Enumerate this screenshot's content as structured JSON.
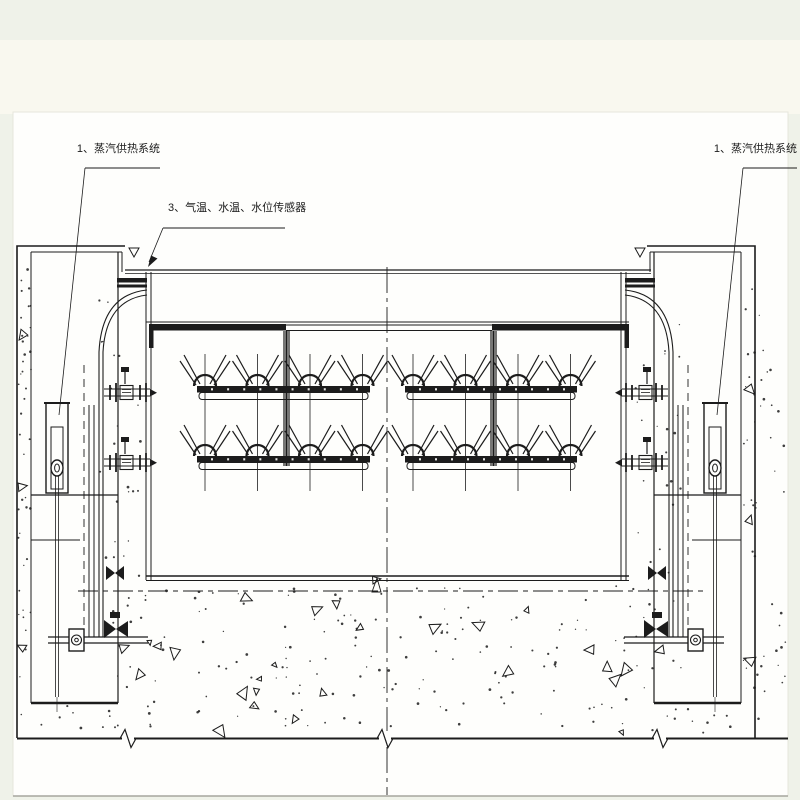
{
  "page": {
    "background": "#eff2e9",
    "upper_band": "#f9f8ef",
    "paper": "#fefefc",
    "ink": "#1c1c1c",
    "edge_line": "#a6a69e"
  },
  "labels": {
    "steam_left": {
      "text": "1、蒸汽供热系统"
    },
    "sensors": {
      "text": "3、气温、水温、水位传感器"
    },
    "steam_right": {
      "text": "1、蒸汽供热系统"
    }
  },
  "drawing": {
    "kind": "gate-elevation-with-steam-heating-system",
    "spray": {
      "rows_y": [
        386,
        456
      ],
      "runs": [
        {
          "x1": 197,
          "x2": 370,
          "nozzles": [
            205,
            257.5,
            310,
            362.5
          ]
        },
        {
          "x1": 405,
          "x2": 577,
          "nozzles": [
            413,
            465.5,
            518,
            570.5
          ]
        }
      ],
      "riser_top": 354,
      "riser_bottom": 491
    },
    "texture": {
      "seed": 12,
      "dot_regions": [
        {
          "x": 18,
          "y": 255,
          "w": 13,
          "h": 475,
          "n": 42
        },
        {
          "x": 96,
          "y": 300,
          "w": 48,
          "h": 390,
          "n": 30
        },
        {
          "x": 126,
          "y": 586,
          "w": 528,
          "h": 148,
          "n": 160
        },
        {
          "x": 632,
          "y": 300,
          "w": 50,
          "h": 390,
          "n": 30
        },
        {
          "x": 742,
          "y": 255,
          "w": 44,
          "h": 475,
          "n": 48
        },
        {
          "x": 34,
          "y": 706,
          "w": 84,
          "h": 28,
          "n": 10
        },
        {
          "x": 656,
          "y": 706,
          "w": 83,
          "h": 28,
          "n": 10
        }
      ],
      "tri_region": {
        "x": 132,
        "y": 596,
        "w": 516,
        "h": 138,
        "n": 24
      },
      "tri_fixed": [
        [
          22,
          335
        ],
        [
          22,
          487
        ],
        [
          22,
          647
        ],
        [
          750,
          390
        ],
        [
          750,
          520
        ],
        [
          750,
          660
        ],
        [
          124,
          648
        ],
        [
          660,
          650
        ],
        [
          336,
          604
        ],
        [
          376,
          580
        ]
      ]
    }
  }
}
